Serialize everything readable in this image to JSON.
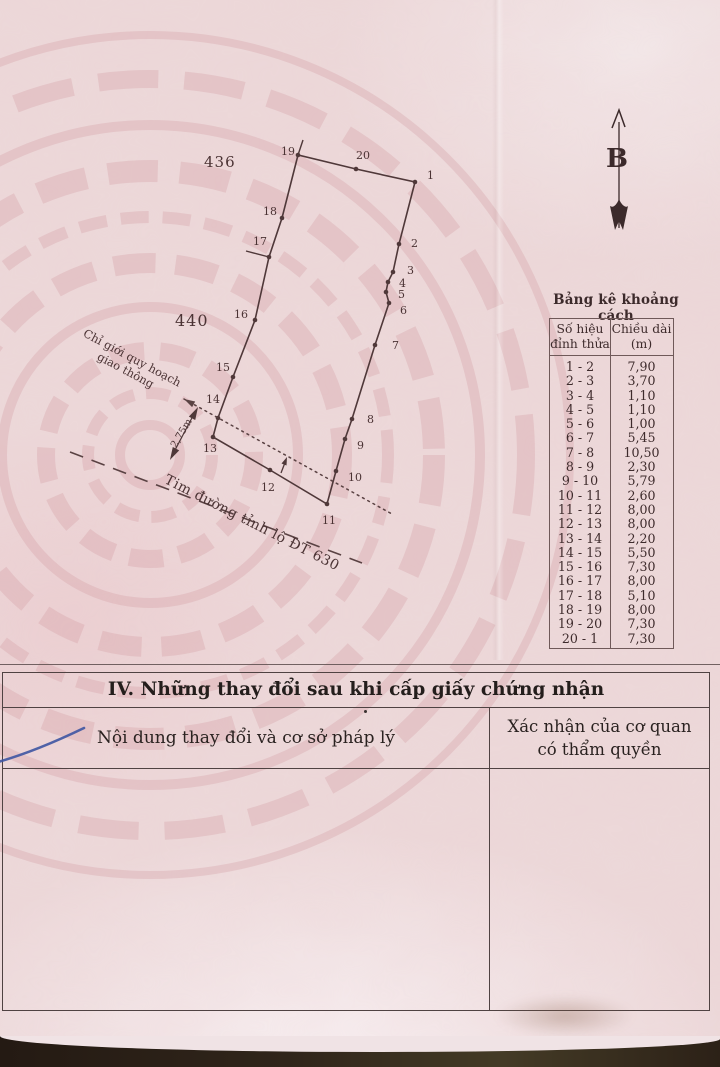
{
  "diagram": {
    "north_label": "B",
    "adjacent_parcels": [
      "436",
      "440"
    ],
    "planning_boundary_label": [
      "Chỉ giới quy hoạch",
      "giao thông"
    ],
    "road_centerline_label": "Tim đường tỉnh lộ ĐT 630",
    "offset_dimension_label": "2,75m",
    "vertices": [
      {
        "label": "1",
        "x": 415,
        "y": 182,
        "lx": 427,
        "ly": 179
      },
      {
        "label": "2",
        "x": 399,
        "y": 244,
        "lx": 411,
        "ly": 247
      },
      {
        "label": "3",
        "x": 393,
        "y": 272,
        "lx": 407,
        "ly": 274
      },
      {
        "label": "4",
        "x": 388,
        "y": 282,
        "lx": 399,
        "ly": 287
      },
      {
        "label": "5",
        "x": 386,
        "y": 292,
        "lx": 398,
        "ly": 298
      },
      {
        "label": "6",
        "x": 389,
        "y": 303,
        "lx": 400,
        "ly": 314
      },
      {
        "label": "7",
        "x": 375,
        "y": 345,
        "lx": 392,
        "ly": 349
      },
      {
        "label": "8",
        "x": 352,
        "y": 419,
        "lx": 367,
        "ly": 423
      },
      {
        "label": "9",
        "x": 345,
        "y": 439,
        "lx": 357,
        "ly": 449
      },
      {
        "label": "10",
        "x": 336,
        "y": 471,
        "lx": 348,
        "ly": 481
      },
      {
        "label": "11",
        "x": 327,
        "y": 504,
        "lx": 322,
        "ly": 524
      },
      {
        "label": "12",
        "x": 270,
        "y": 470,
        "lx": 261,
        "ly": 491
      },
      {
        "label": "13",
        "x": 213,
        "y": 437,
        "lx": 203,
        "ly": 452
      },
      {
        "label": "14",
        "x": 218,
        "y": 418,
        "lx": 206,
        "ly": 403
      },
      {
        "label": "15",
        "x": 233,
        "y": 377,
        "lx": 216,
        "ly": 371
      },
      {
        "label": "16",
        "x": 255,
        "y": 320,
        "lx": 234,
        "ly": 318
      },
      {
        "label": "17",
        "x": 269,
        "y": 257,
        "lx": 253,
        "ly": 245
      },
      {
        "label": "18",
        "x": 282,
        "y": 218,
        "lx": 263,
        "ly": 215
      },
      {
        "label": "19",
        "x": 298,
        "y": 155,
        "lx": 281,
        "ly": 155
      },
      {
        "label": "20",
        "x": 356,
        "y": 169,
        "lx": 356,
        "ly": 159
      }
    ]
  },
  "distance_table": {
    "title": "Bảng kê khoảng cách",
    "headers": {
      "col1": [
        "Số hiệu",
        "đỉnh thửa"
      ],
      "col2": [
        "Chiều dài",
        "(m)"
      ]
    },
    "rows": [
      {
        "segment": "1 - 2",
        "length": "7,90"
      },
      {
        "segment": "2 - 3",
        "length": "3,70"
      },
      {
        "segment": "3 - 4",
        "length": "1,10"
      },
      {
        "segment": "4 - 5",
        "length": "1,10"
      },
      {
        "segment": "5 - 6",
        "length": "1,00"
      },
      {
        "segment": "6 - 7",
        "length": "5,45"
      },
      {
        "segment": "7 - 8",
        "length": "10,50"
      },
      {
        "segment": "8 - 9",
        "length": "2,30"
      },
      {
        "segment": "9 - 10",
        "length": "5,79"
      },
      {
        "segment": "10 - 11",
        "length": "2,60"
      },
      {
        "segment": "11 - 12",
        "length": "8,00"
      },
      {
        "segment": "12 - 13",
        "length": "8,00"
      },
      {
        "segment": "13 - 14",
        "length": "2,20"
      },
      {
        "segment": "14 - 15",
        "length": "5,50"
      },
      {
        "segment": "15 - 16",
        "length": "7,30"
      },
      {
        "segment": "16 - 17",
        "length": "8,00"
      },
      {
        "segment": "17 - 18",
        "length": "5,10"
      },
      {
        "segment": "18 - 19",
        "length": "8,00"
      },
      {
        "segment": "19 - 20",
        "length": "7,30"
      },
      {
        "segment": "20 - 1",
        "length": "7,30"
      }
    ]
  },
  "section_iv": {
    "title": "IV. Những thay đổi sau khi cấp giấy chứng nhận",
    "left_header": "Nội dung thay đổi và cơ sở pháp lý",
    "right_header": [
      "Xác nhận của cơ quan",
      "có thẩm quyền"
    ]
  },
  "colors": {
    "paper": "#ecd8d9",
    "ink": "#4b3334",
    "pen_blue": "#3e55a2"
  }
}
